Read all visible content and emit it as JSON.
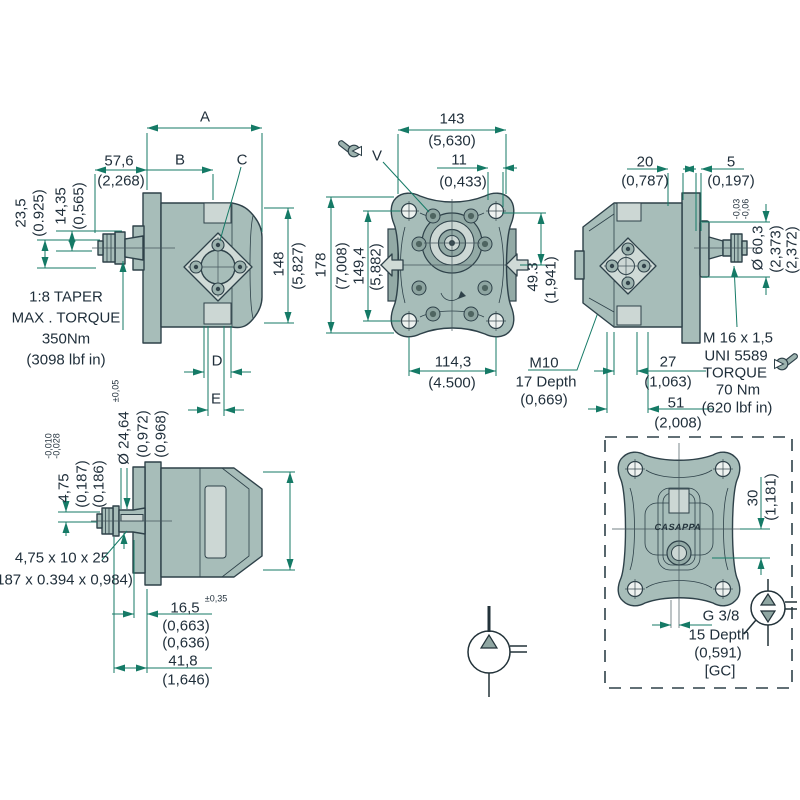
{
  "v1": {
    "a": "A",
    "b": "B",
    "c": "C",
    "d": "D",
    "e": "E",
    "w576": "57,6",
    "w576i": "(2,268)",
    "h235": "23,5",
    "h235i": "(0.925)",
    "h1435": "14,35",
    "h1435i": "(0,565)",
    "h148": "148",
    "h148i": "(5,827)",
    "note": [
      "1:8 TAPER",
      "MAX . TORQUE",
      "350Nm",
      "(3098 lbf in)"
    ]
  },
  "v2": {
    "w143": "143",
    "w143i": "(5,630)",
    "w11": "11",
    "w11i": "(0,433)",
    "v": "V",
    "h178": "178",
    "h178i": "(7,008)",
    "h1494": "149,4",
    "h1494i": "(5,882)",
    "h493": "49.3",
    "h493i": "(1,941)",
    "w1143": "114,3",
    "w1143i": "(4.500)",
    "m10": [
      "M10",
      "17 Depth",
      "(0,669)"
    ]
  },
  "v3": {
    "w20": "20",
    "w20i": "(0,787)",
    "w5": "5",
    "w5i": "(0,197)",
    "tol1": "-0,03",
    "tol2": "-0,06",
    "d603": "Ø 60,3",
    "d603i1": "(2,373)",
    "d603i2": "(2,372)",
    "m16": [
      "M 16 x 1,5",
      "UNI 5589",
      "TORQUE",
      "70 Nm",
      "(620 lbf in)"
    ],
    "w27": "27",
    "w27i": "(1,063)",
    "w51": "51",
    "w51i": "(2,008)"
  },
  "v4": {
    "tol05": "±0,05",
    "d2464": "Ø 24,64",
    "d2464i1": "(0,972)",
    "d2464i2": "(0,968)",
    "tol1": "-0,010",
    "tol2": "-0,028",
    "h475": "4,75",
    "h475i1": "(0,187)",
    "h475i2": "(0,186)",
    "key1": "4,75 x 10 x 25",
    "key2": "(187 x 0.394 x 0,984)",
    "w165": "16,5",
    "tol035": "±0,35",
    "w165i1": "(0,663)",
    "w165i2": "(0,636)",
    "w418": "41,8",
    "w418i": "(1,646)"
  },
  "v5": {
    "h30": "30",
    "h30i": "(1,181)",
    "port": [
      "G 3/8",
      "15 Depth",
      "(0,591)",
      "[GC]"
    ],
    "brand": "CASAPPA"
  },
  "colors": {
    "body": "#a7bdb9",
    "body_dark": "#93aaa6",
    "light_fill": "#ccd7d4",
    "outline": "#2e4149",
    "dimension": "#157a66",
    "text": "#1f2e3a"
  }
}
